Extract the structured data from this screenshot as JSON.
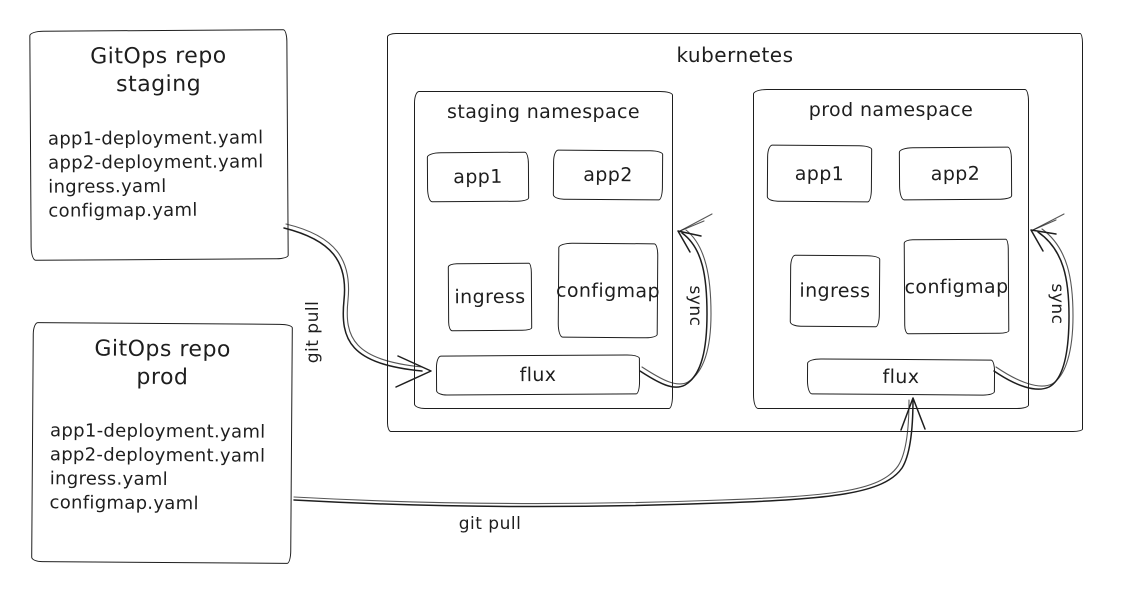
{
  "colors": {
    "stroke": "#1e1e1e",
    "background": "#ffffff"
  },
  "repos": [
    {
      "title_line1": "GitOps repo",
      "title_line2": "staging",
      "files": [
        "app1-deployment.yaml",
        "app2-deployment.yaml",
        "ingress.yaml",
        "configmap.yaml"
      ]
    },
    {
      "title_line1": "GitOps repo",
      "title_line2": "prod",
      "files": [
        "app1-deployment.yaml",
        "app2-deployment.yaml",
        "ingress.yaml",
        "configmap.yaml"
      ]
    }
  ],
  "kubernetes": {
    "title": "kubernetes",
    "namespaces": [
      {
        "title": "staging namespace",
        "boxes": {
          "app1": "app1",
          "app2": "app2",
          "ingress": "ingress",
          "configmap": "configmap",
          "flux": "flux"
        }
      },
      {
        "title": "prod namespace",
        "boxes": {
          "app1": "app1",
          "app2": "app2",
          "ingress": "ingress",
          "configmap": "configmap",
          "flux": "flux"
        }
      }
    ]
  },
  "labels": {
    "git_pull_staging": "git pull",
    "git_pull_prod": "git pull",
    "sync_staging": "sync",
    "sync_prod": "sync"
  }
}
